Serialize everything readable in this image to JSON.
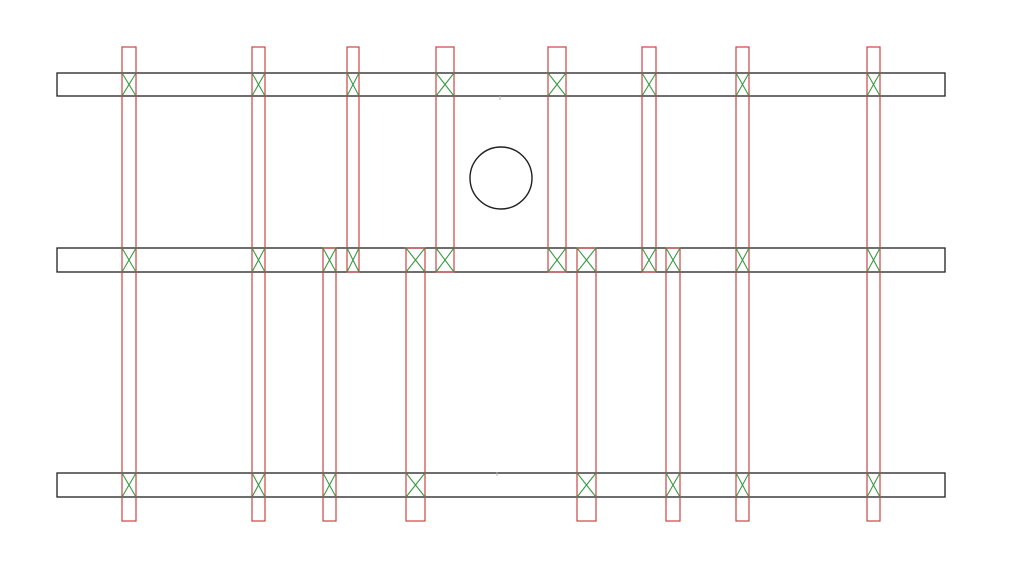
{
  "canvas": {
    "width": 1009,
    "height": 587,
    "background": "#ffffff"
  },
  "colors": {
    "rail_stroke": "#202020",
    "strip_stroke": "#cc4343",
    "x_mark_stroke": "#3a9a44",
    "circle_stroke": "#202020",
    "tick_color": "#b5b5b5"
  },
  "rails": [
    {
      "id": "rail-top",
      "x": 57,
      "y": 73,
      "width": 888,
      "height": 23
    },
    {
      "id": "rail-middle",
      "x": 57,
      "y": 248,
      "width": 888,
      "height": 24
    },
    {
      "id": "rail-bottom",
      "x": 57,
      "y": 473,
      "width": 888,
      "height": 24
    }
  ],
  "strips": [
    {
      "id": "strip-01-full",
      "span": "full",
      "x": 122,
      "width": 14,
      "y_top": 47,
      "y_bottom": 521
    },
    {
      "id": "strip-02-full",
      "span": "full",
      "x": 252,
      "width": 13,
      "y_top": 47,
      "y_bottom": 521
    },
    {
      "id": "strip-03-lower",
      "span": "lower",
      "x": 323,
      "width": 13,
      "y_top": 248,
      "y_bottom": 521
    },
    {
      "id": "strip-04-upper",
      "span": "upper",
      "x": 347,
      "width": 12,
      "y_top": 47,
      "y_bottom": 272
    },
    {
      "id": "strip-05-lower",
      "span": "lower",
      "x": 406,
      "width": 19,
      "y_top": 248,
      "y_bottom": 521
    },
    {
      "id": "strip-06-upper",
      "span": "upper",
      "x": 436,
      "width": 18,
      "y_top": 47,
      "y_bottom": 272
    },
    {
      "id": "strip-07-upper",
      "span": "upper",
      "x": 548,
      "width": 18,
      "y_top": 47,
      "y_bottom": 272
    },
    {
      "id": "strip-08-lower",
      "span": "lower",
      "x": 577,
      "width": 19,
      "y_top": 248,
      "y_bottom": 521
    },
    {
      "id": "strip-09-upper",
      "span": "upper",
      "x": 642,
      "width": 14,
      "y_top": 47,
      "y_bottom": 272
    },
    {
      "id": "strip-10-lower",
      "span": "lower",
      "x": 666,
      "width": 14,
      "y_top": 248,
      "y_bottom": 521
    },
    {
      "id": "strip-11-full",
      "span": "full",
      "x": 736,
      "width": 13,
      "y_top": 47,
      "y_bottom": 521
    },
    {
      "id": "strip-12-full",
      "span": "full",
      "x": 867,
      "width": 13,
      "y_top": 47,
      "y_bottom": 521
    }
  ],
  "circle": {
    "cx": 501,
    "cy": 178,
    "r": 31
  },
  "center_ticks": [
    {
      "x": 500,
      "y": 98
    },
    {
      "x": 497,
      "y": 474
    }
  ],
  "stroke_widths": {
    "rail": 1.3,
    "strip": 1.2,
    "x_mark": 1.1,
    "circle": 1.4
  }
}
